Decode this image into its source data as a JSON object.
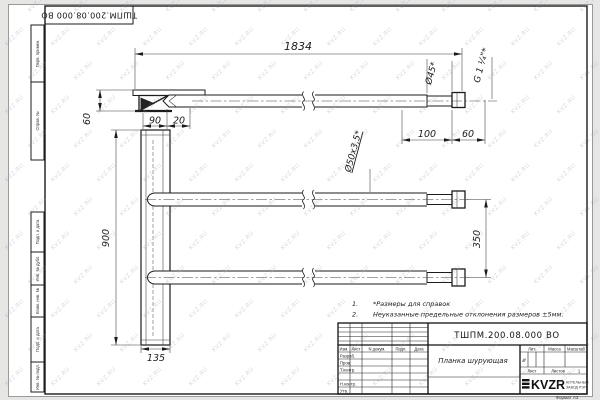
{
  "watermark": "KVZ.RU",
  "sheet": {
    "stamp_top": "ТШПМ.200.08.000 ВО",
    "margin_labels": [
      "Перв. примен.",
      "Справ. №",
      "Подп. и дата",
      "Инв. № дубл.",
      "Взам. инв. №",
      "Подп. и дата",
      "Инв. № подл."
    ],
    "format_note": "Формат А3"
  },
  "drawing": {
    "dims": {
      "total_length": "1834",
      "flange_height": "60",
      "offset_90": "90",
      "offset_20": "20",
      "plate_height": "900",
      "plate_width": "135",
      "tube_spacing": "350",
      "end_length": "100",
      "thread_length": "60",
      "end_diameter": "Ø45*",
      "thread_spec": "G 1 ¼\"*",
      "tube_spec": "Ø50x3,5*"
    },
    "notes": [
      {
        "num": "1.",
        "text": "*Размеры для справок"
      },
      {
        "num": "2.",
        "text": "Неуказанные предельные отклонения размеров ±5мм."
      }
    ]
  },
  "title_block": {
    "doc_number": "ТШПМ.200.08.000 ВО",
    "part_name": "Планка шурующая",
    "col_headers": {
      "izm": "Изм.",
      "list": "Лист",
      "ndoc": "N докум.",
      "podp": "Подп.",
      "data": "Дата"
    },
    "sign_rows": {
      "razrab": "Разраб.",
      "prov": "Пров.",
      "tkontr": "Т.контр.",
      "nkontr": "Н.контр.",
      "utv": "Утв."
    },
    "props": {
      "lit_label": "Лит.",
      "lit_value": "И",
      "massa_label": "Масса",
      "scale_label": "Масштаб",
      "sheet_label": "Лист",
      "sheets_label": "Листов",
      "sheets_value": "1"
    },
    "company": {
      "logo": "KVZR",
      "line1": "КОТЕЛЬНЫЙ",
      "line2": "ЗАВОД РЭП"
    }
  }
}
